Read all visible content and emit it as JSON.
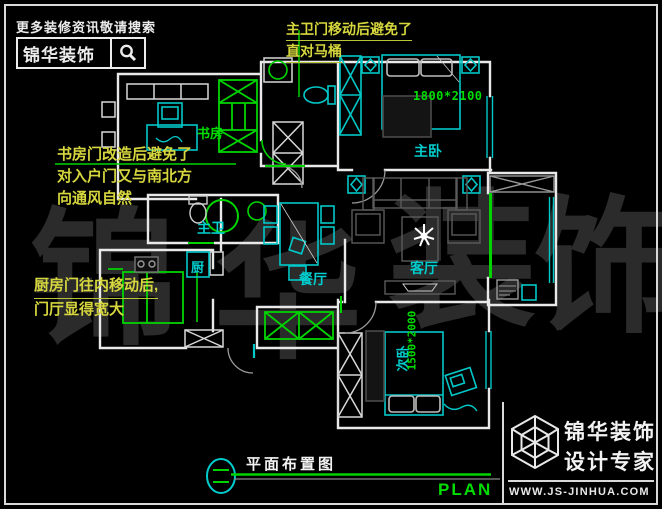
{
  "promo": {
    "tagline": "更多装修资讯敬请搜索",
    "brand": "锦华装饰",
    "icon": "search-icon"
  },
  "annotations": {
    "top_bath": {
      "lines": [
        "主卫门移动后避免了",
        "直对马桶"
      ]
    },
    "study": {
      "lines": [
        "书房门改造后避免了",
        "对入户门又与南北方",
        "向通风自然"
      ]
    },
    "kitchen": {
      "lines": [
        "厨房门往内移动后,",
        "门厅显得宽大"
      ]
    }
  },
  "rooms": {
    "study": "书房",
    "master_bedroom": "主卧",
    "master_bath": "主卫",
    "kitchen": "厨",
    "dining": "餐厅",
    "living": "客厅",
    "second_bedroom": "次卧"
  },
  "dimensions": {
    "master_bed": "1800*2100",
    "second_bed": "1500*2000"
  },
  "watermark": {
    "chars": [
      "锦",
      "华",
      "装",
      "饰"
    ]
  },
  "title_block": {
    "title": "平面布置图",
    "plan": "PLAN",
    "icon": "section-marker-icon"
  },
  "footer": {
    "brand_top": "锦华装饰",
    "brand_bottom": "设计专家",
    "website": "WWW.JS-JINHUA.COM",
    "icon": "cube-logo-icon"
  },
  "colors": {
    "background": "#000000",
    "wall_white": "#e9e9e9",
    "cad_green": "#00d400",
    "cad_cyan": "#00cdcd",
    "annotation_yellow": "#d6d63e",
    "furniture_gray": "#555555",
    "watermark_gray": "#2b2b2b"
  }
}
